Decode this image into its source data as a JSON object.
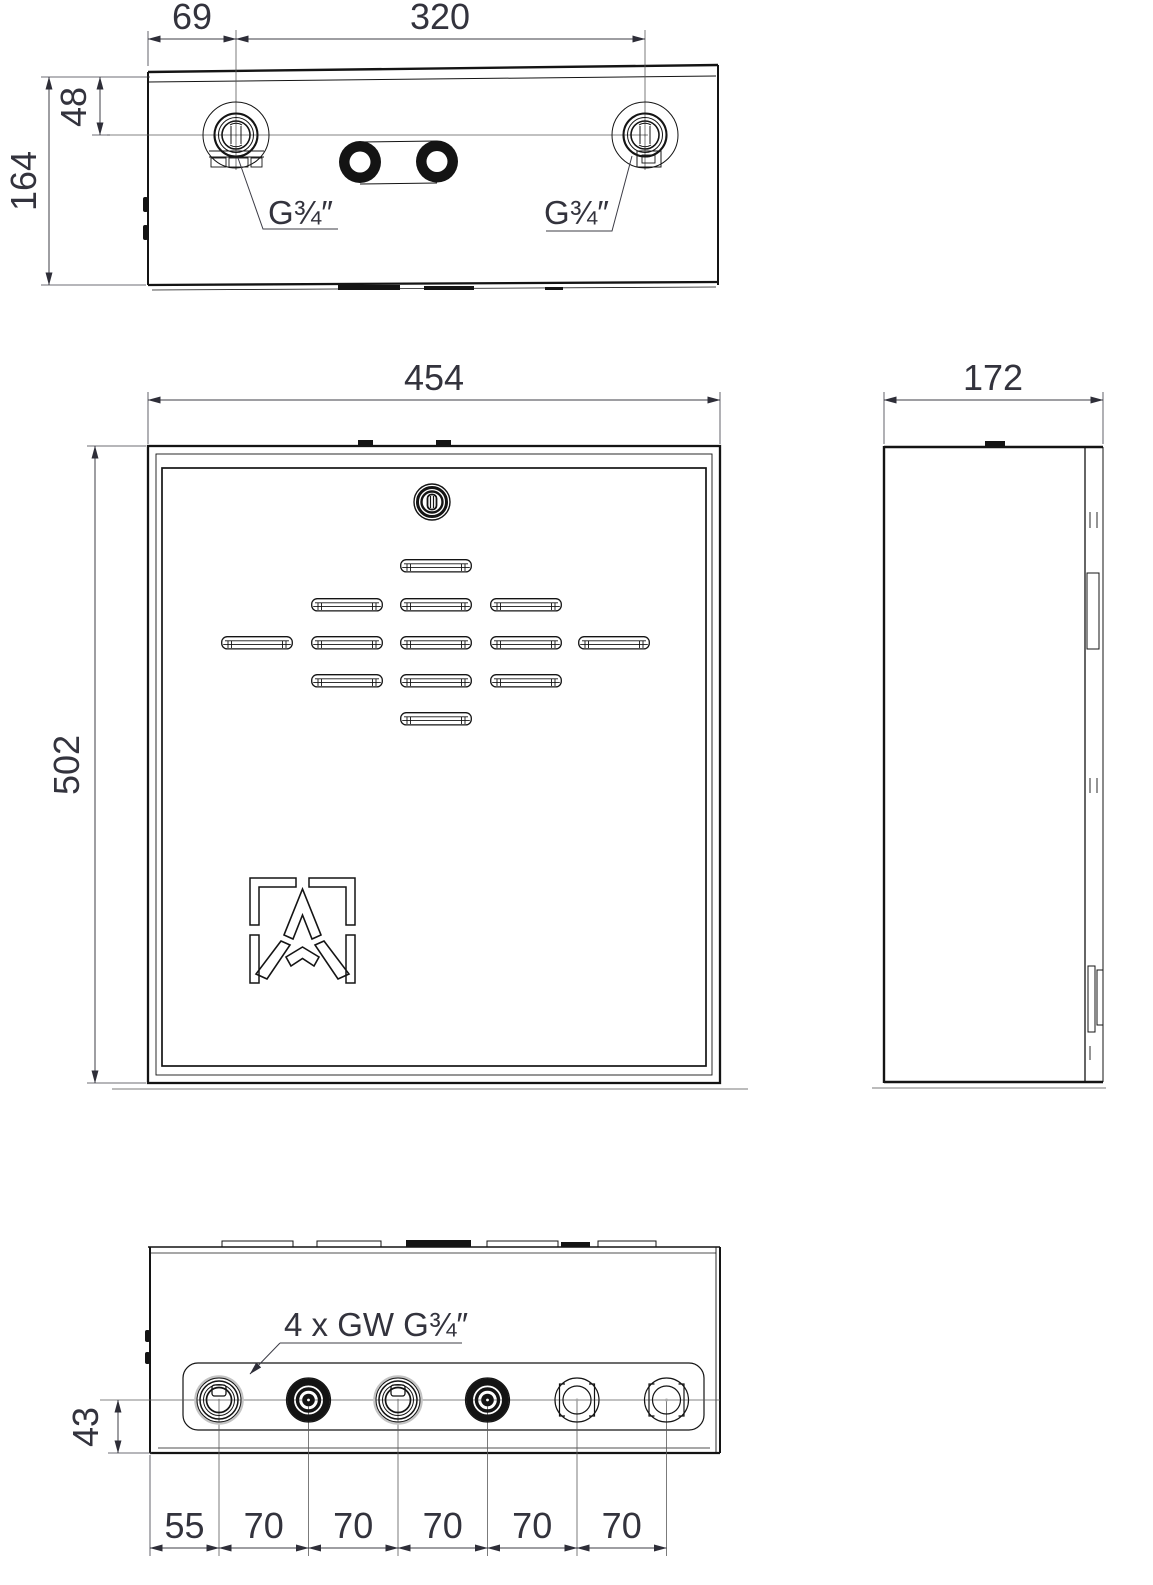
{
  "top_view": {
    "port_offset_x": "69",
    "port_spacing": "320",
    "port_offset_y": "48",
    "depth": "164",
    "port_thread_left": "G¾″",
    "port_thread_right": "G¾″"
  },
  "front_view": {
    "width": "454",
    "height": "502"
  },
  "side_view": {
    "depth": "172"
  },
  "bottom_view": {
    "ports_note": "4 x GW G¾″",
    "port_axis_offset": "43",
    "spacings": [
      "55",
      "70",
      "70",
      "70",
      "70",
      "70"
    ]
  }
}
